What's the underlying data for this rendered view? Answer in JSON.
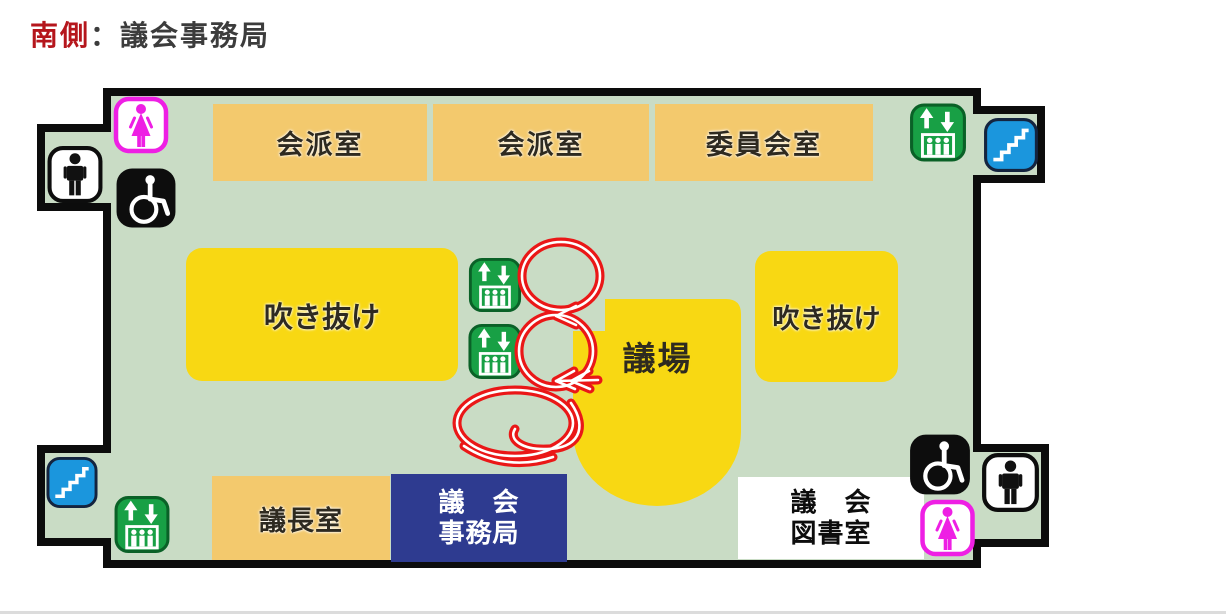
{
  "title": {
    "region": "南側",
    "separator": "：",
    "name": "議会事務局"
  },
  "rooms": {
    "faction_room_1": "会派室",
    "faction_room_2": "会派室",
    "committee_room": "委員会室",
    "atrium_left": "吹き抜け",
    "atrium_right": "吹き抜け",
    "assembly_hall": "議場",
    "chairman_room": "議長室",
    "secretariat_line1": "議　会",
    "secretariat_line2": "事務局",
    "library_line1": "議　会",
    "library_line2": "図書室"
  },
  "icons": {
    "female_restroom": "female-restroom-icon",
    "male_restroom": "male-restroom-icon",
    "wheelchair": "wheelchair-icon",
    "elevator": "elevator-icon",
    "stairs": "stairs-icon"
  },
  "annotation": {
    "type": "hand-drawn red scribble",
    "shape": "two stacked loops with left arrows and lower loop with hook"
  },
  "colors": {
    "floor_bg": "#c9dcc5",
    "outline_black": "#0c0c0c",
    "room_tan": "#f3c96d",
    "room_yellow": "#f8d813",
    "secretariat_navy": "#2e3b90",
    "elevator_green": "#18a045",
    "stairs_blue": "#1b96dd",
    "restroom_magenta": "#ee1fe4",
    "annotation_red": "#ea1717",
    "title_red": "#b5161c"
  }
}
